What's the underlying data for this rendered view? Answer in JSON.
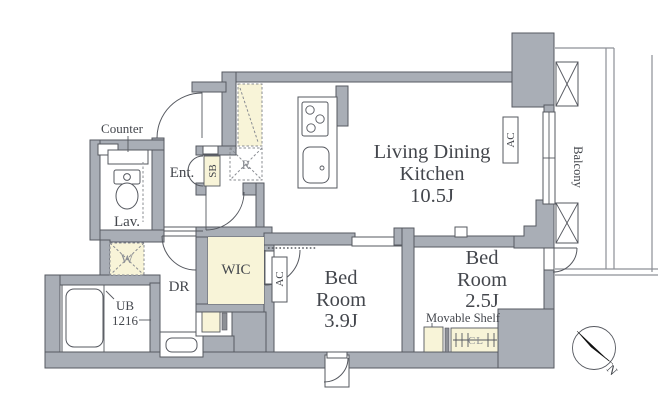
{
  "colors": {
    "wall": "#a9aeb6",
    "wall_stroke": "#565a61",
    "beige": "#f8f4d8",
    "line": "#55585f",
    "text": "#44474d",
    "muted": "#898c92",
    "balcony_line": "#8d9096",
    "white": "#ffffff"
  },
  "rooms": {
    "ldk": {
      "name_line1": "Living Dining",
      "name_line2": "Kitchen",
      "size": "10.5J"
    },
    "bedroom_a": {
      "name_line1": "Bed",
      "name_line2": "Room",
      "size": "3.9J"
    },
    "bedroom_b": {
      "name_line1": "Bed",
      "name_line2": "Room",
      "size": "2.5J"
    },
    "wic": {
      "label": "WIC"
    },
    "dressing_room": {
      "label": "DR"
    },
    "lavatory": {
      "label": "Lav."
    },
    "entrance": {
      "label": "Ent."
    },
    "unit_bath": {
      "label_line1": "UB",
      "label_line2": "1216"
    },
    "balcony": {
      "label": "Balcony"
    }
  },
  "fixtures": {
    "counter": {
      "label": "Counter"
    },
    "shoe_box": {
      "label": "SB"
    },
    "refrigerator": {
      "label": "R"
    },
    "washer": {
      "label": "W"
    },
    "air_conditioner": {
      "label": "AC"
    },
    "movable_shelf": {
      "label": "Movable Shelf"
    },
    "closet": {
      "label": "CL"
    }
  },
  "compass": {
    "north_label": "N"
  }
}
